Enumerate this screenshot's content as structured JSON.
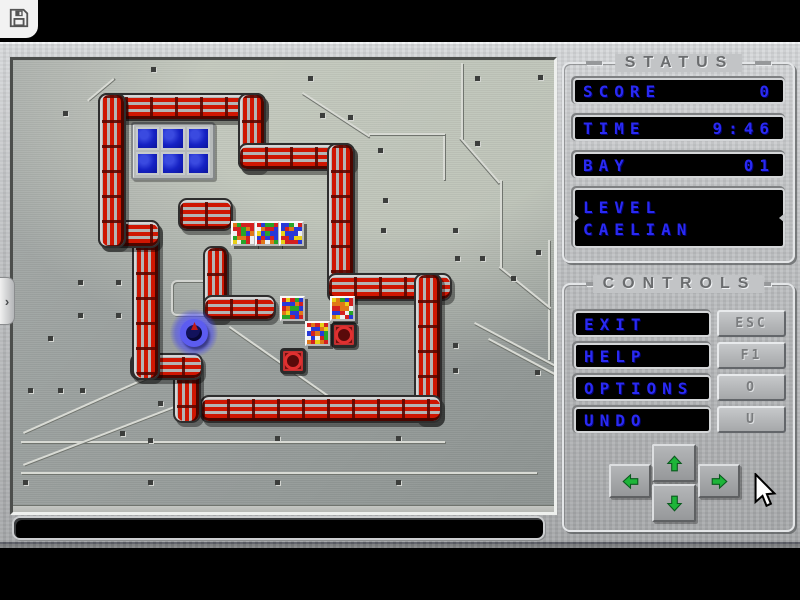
{
  "toolbar": {
    "save_icon": "floppy-disk"
  },
  "drawer_tab": {
    "chevron": "›"
  },
  "status_panel": {
    "title": "STATUS",
    "rows": [
      {
        "label": "SCORE",
        "value": "0"
      },
      {
        "label": "TIME",
        "value": "9:46"
      },
      {
        "label": "BAY",
        "value": "01"
      }
    ],
    "level_label": "LEVEL",
    "level_name": "CAELIAN"
  },
  "controls_panel": {
    "title": "CONTROLS",
    "buttons": [
      {
        "label": "EXIT",
        "key": "ESC"
      },
      {
        "label": "HELP",
        "key": "F1"
      },
      {
        "label": "OPTIONS",
        "key": "O"
      },
      {
        "label": "UNDO",
        "key": "U"
      }
    ],
    "arrows": [
      "up",
      "left",
      "down",
      "right"
    ]
  },
  "message_bar": {
    "text": ""
  },
  "board": {
    "walls": [
      [
        85,
        33,
        168,
        28,
        "h"
      ],
      [
        225,
        33,
        28,
        78,
        "v"
      ],
      [
        225,
        83,
        117,
        28,
        "h"
      ],
      [
        314,
        83,
        28,
        160,
        "v"
      ],
      [
        314,
        213,
        125,
        28,
        "h"
      ],
      [
        401,
        213,
        28,
        150,
        "v"
      ],
      [
        187,
        335,
        242,
        28,
        "h"
      ],
      [
        160,
        293,
        28,
        70,
        "v"
      ],
      [
        117,
        293,
        73,
        27,
        "h"
      ],
      [
        119,
        160,
        28,
        160,
        "v"
      ],
      [
        85,
        160,
        62,
        28,
        "h"
      ],
      [
        85,
        33,
        28,
        155,
        "v"
      ],
      [
        165,
        138,
        55,
        33,
        "h"
      ],
      [
        190,
        186,
        26,
        75,
        "v"
      ],
      [
        190,
        235,
        73,
        26,
        "h"
      ]
    ],
    "glass_area": {
      "x": 118,
      "y": 62,
      "cols": 3,
      "rows": 2,
      "width": 84,
      "height": 58
    },
    "crates": [
      [
        218,
        161
      ],
      [
        242,
        161
      ],
      [
        266,
        161
      ],
      [
        267,
        236
      ],
      [
        317,
        236
      ],
      [
        292,
        261
      ]
    ],
    "targets": [
      [
        318,
        262
      ],
      [
        267,
        288
      ]
    ],
    "player": {
      "x": 164,
      "y": 256
    }
  },
  "cursor": {
    "x": 750,
    "y": 473
  },
  "colors": {
    "accent_blue": "#2a2af2",
    "wall_red": "#cf1602",
    "arrow_green": "#1db539",
    "target_red": "#d83030"
  }
}
